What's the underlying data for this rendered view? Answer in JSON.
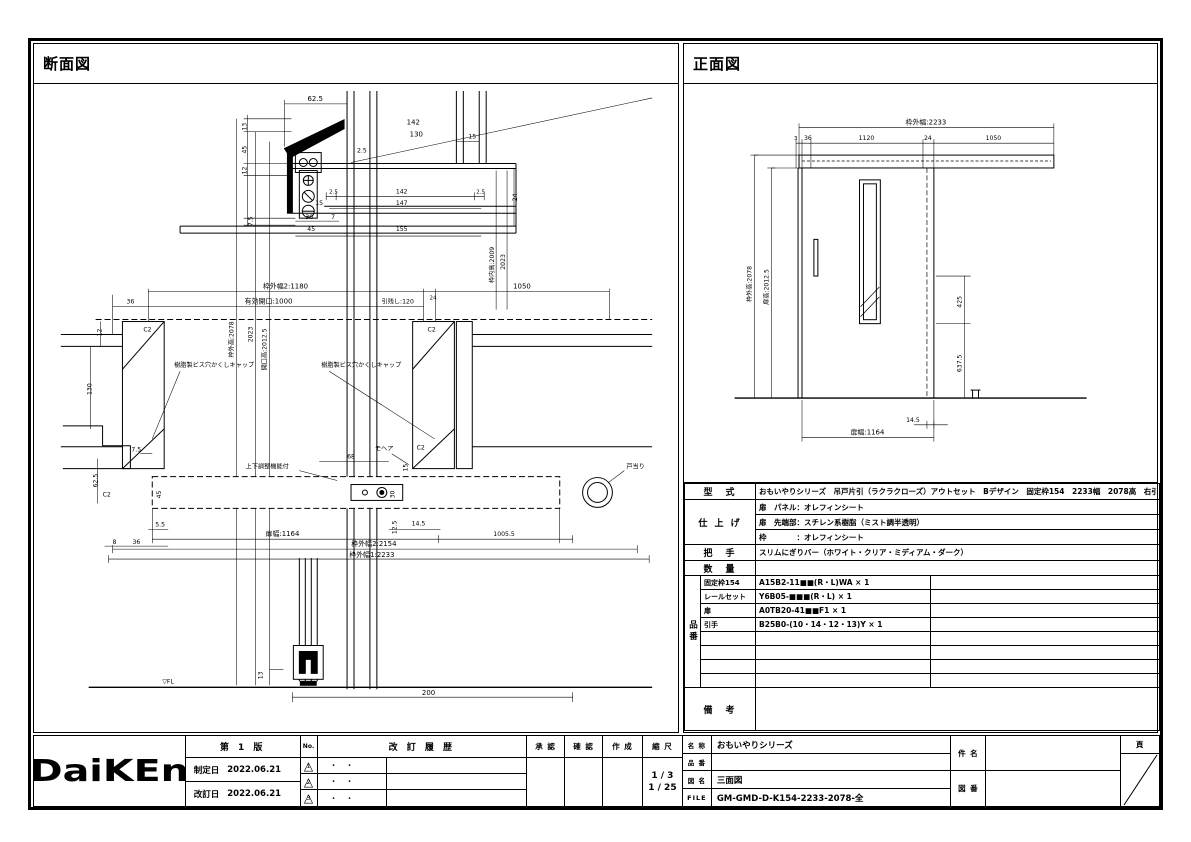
{
  "panels": {
    "section_title": "断面図",
    "front_title": "正面図"
  },
  "section_view": {
    "labels": [
      "62.5",
      "142",
      "130",
      "15",
      "2.5",
      "13",
      "45",
      "12",
      "7.5",
      "24",
      "2.5",
      "142",
      "2.5",
      "147",
      "15",
      "30",
      "7",
      "45",
      "155",
      "枠外高:2078",
      "2023",
      "開口高:2012.5",
      "枠内高:2009",
      "2023",
      "枠外幅2:1180",
      "24",
      "1050",
      "36",
      "有効開口:1000",
      "引残し:120",
      "C2",
      "C2",
      "樹脂製ビス穴かくしキャップ",
      "樹脂製ビス穴かくしキャップ",
      "12",
      "130",
      "62.5",
      "7.5",
      "C2",
      "モヘア",
      "戸当り",
      "上下調整機能付",
      "68",
      "15",
      "30",
      "45",
      "5.5",
      "36",
      "8",
      "12.5",
      "14.5",
      "1005.5",
      "扉幅:1164",
      "枠外幅2:2154",
      "枠外幅1:2233",
      "▽FL",
      "13",
      "200",
      "C2"
    ]
  },
  "front_view": {
    "labels": [
      "枠外幅:2233",
      "3",
      "36",
      "1120",
      "24",
      "1050",
      "枠外高:2078",
      "扉高:2012.5",
      "425",
      "637.5",
      "14.5",
      "扉幅:1164"
    ]
  },
  "spec": {
    "model_label": "型　式",
    "model_value": "おもいやりシリーズ　吊戸片引（ラクラクローズ）アウトセット　Bデザイン　固定枠154　2233幅　2078高　右引",
    "finish_label": "仕 上 げ",
    "finish1": "扉　パネル：オレフィンシート",
    "finish2": "扉　先端部：スチレン系樹脂（ミスト調半透明）",
    "finish3": "枠　　　　：オレフィンシート",
    "handle_label": "把　手",
    "handle_value": "スリムにぎりバー（ホワイト・クリア・ミディアム・ダーク）",
    "qty_label": "数　量",
    "qty_value": "",
    "parts_label": "品番",
    "parts": [
      {
        "name": "固定枠154",
        "code": "A15B2-11■■(R・L)WA × 1"
      },
      {
        "name": "レールセット",
        "code": "Y6B05-■■■(R・L) × 1"
      },
      {
        "name": "扉",
        "code": "A0TB20-41■■F1 × 1"
      },
      {
        "name": "引手",
        "code": "B25B0-(10・14・12・13)Y × 1"
      },
      {
        "name": "",
        "code": ""
      },
      {
        "name": "",
        "code": ""
      },
      {
        "name": "",
        "code": ""
      },
      {
        "name": "",
        "code": ""
      }
    ],
    "notes_label": "備　考",
    "notes_value": ""
  },
  "titleblock": {
    "brand": "DaiKEn",
    "edition": "第 1 版",
    "enacted_label": "制定日",
    "enacted_date": "2022.06.21",
    "revised_label": "改訂日",
    "revised_date": "2022.06.21",
    "no_label": "No.",
    "rev_mark": "△",
    "rev_nums": [
      "1",
      "2",
      "3"
    ],
    "rev_history_label": "改 訂 履 歴",
    "rev_date_placeholder": "・　・",
    "approve_label": "承 認",
    "check_label": "確 認",
    "create_label": "作 成",
    "scale_label": "縮 尺",
    "scale1": "1 / 3",
    "scale2": "1 / 25",
    "name_label": "名 称",
    "name_value": "おもいやりシリーズ",
    "part_label": "品 番",
    "part_value": "",
    "drawing_label": "図 名",
    "drawing_value": "三面図",
    "file_label": "FILE",
    "file_value": "GM-GMD-D-K154-2233-2078-全",
    "subject_label": "件 名",
    "subject_value": "",
    "dwgno_label": "図 番",
    "dwgno_value": "",
    "page_label": "頁"
  }
}
